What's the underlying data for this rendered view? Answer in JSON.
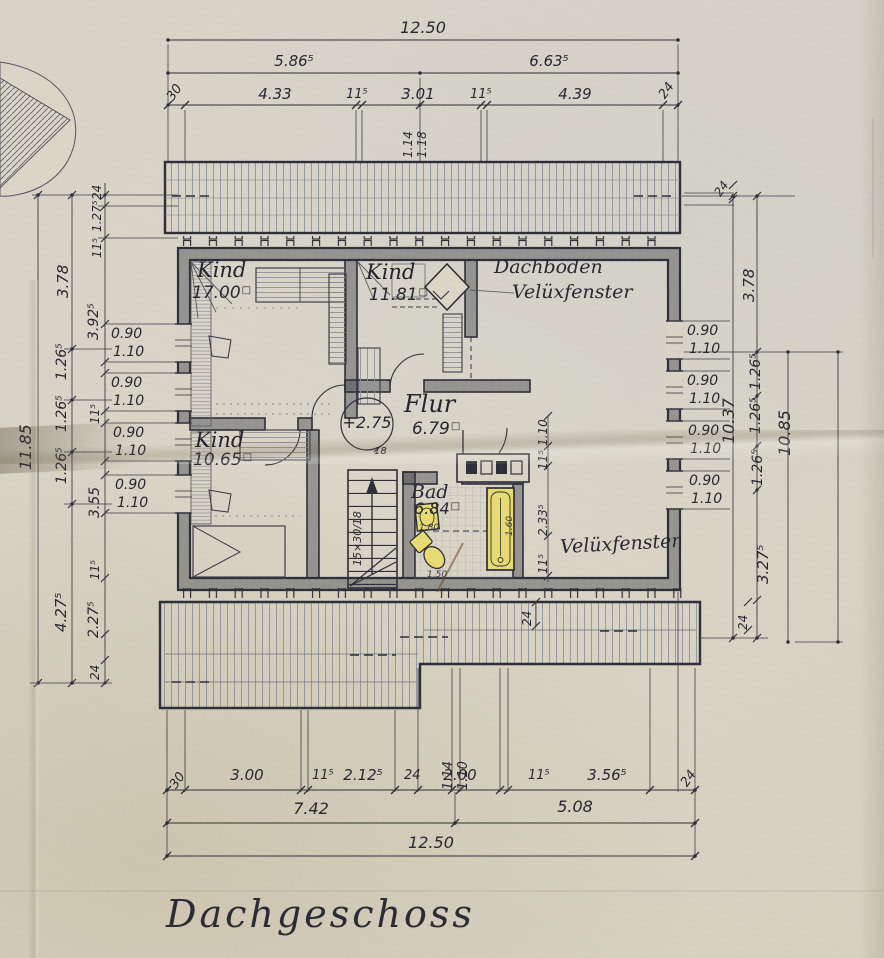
{
  "title": "Dachgeschoss",
  "rooms": {
    "kind1": {
      "name": "Kind",
      "area": "17.00",
      "unit": "□"
    },
    "kind2": {
      "name": "Kind",
      "area": "11.81",
      "unit": "□"
    },
    "kind3": {
      "name": "Kind",
      "area": "10.65",
      "unit": "□"
    },
    "flur": {
      "name": "Flur",
      "area": "6.79",
      "unit": "□"
    },
    "bad": {
      "name": "Bad",
      "area": "6.84",
      "unit": "□"
    },
    "dachboden": "Dachboden",
    "velux_top": "Velüxfenster",
    "velux_bottom": "Velüxfenster"
  },
  "level_marker": {
    "value": "+2.75",
    "note": "18"
  },
  "stairs_note": "15×30/18",
  "bath_marks": {
    "a": "1.80",
    "b": "1.60",
    "c": "1.50"
  },
  "dim_top": {
    "total": "12.50",
    "mid": [
      "5.86⁵",
      "6.63⁵"
    ],
    "detail": [
      "30",
      "4.33",
      "11⁵",
      "3.01",
      "11⁵",
      "4.39",
      "24"
    ],
    "vertical": [
      "1.14",
      "1.18"
    ]
  },
  "dim_bottom": {
    "detail": [
      "30",
      "3.00",
      "11⁵",
      "2.12⁵",
      "24",
      "2.00",
      "11⁵",
      "3.56⁵",
      "24"
    ],
    "vertical": [
      "1.14",
      "1.10"
    ],
    "mid": [
      "7.42",
      "5.08"
    ],
    "total": "12.50"
  },
  "dim_left": {
    "total": "11.85",
    "outer": [
      "3.78",
      "1.26⁵",
      "1.26⁵",
      "1.26⁵",
      "4.27⁵"
    ],
    "inner": [
      "24",
      "1.27⁵",
      "11⁵",
      "3.92⁵",
      "11⁵",
      "3.55",
      "11⁵",
      "2.27⁵",
      "24"
    ],
    "windows": [
      [
        "0.90",
        "1.10"
      ],
      [
        "0.90",
        "1.10"
      ],
      [
        "0.90",
        "1.10"
      ],
      [
        "0.90",
        "1.10"
      ]
    ]
  },
  "dim_right": {
    "top": "24",
    "outer": [
      "3.78",
      "1.26⁵",
      "1.26⁵",
      "1.26⁵",
      "3.27⁵"
    ],
    "bottom": "24",
    "totals": [
      "10.37",
      "10.85"
    ],
    "windows": [
      [
        "0.90",
        "1.10"
      ],
      [
        "0.90",
        "1.10"
      ],
      [
        "0.90",
        "1.10"
      ],
      [
        "0.90",
        "1.10"
      ]
    ]
  },
  "dim_inner": {
    "bath_chain": [
      "1.10",
      "11⁵",
      "2.33⁵",
      "11⁵"
    ],
    "eaves": "24"
  }
}
